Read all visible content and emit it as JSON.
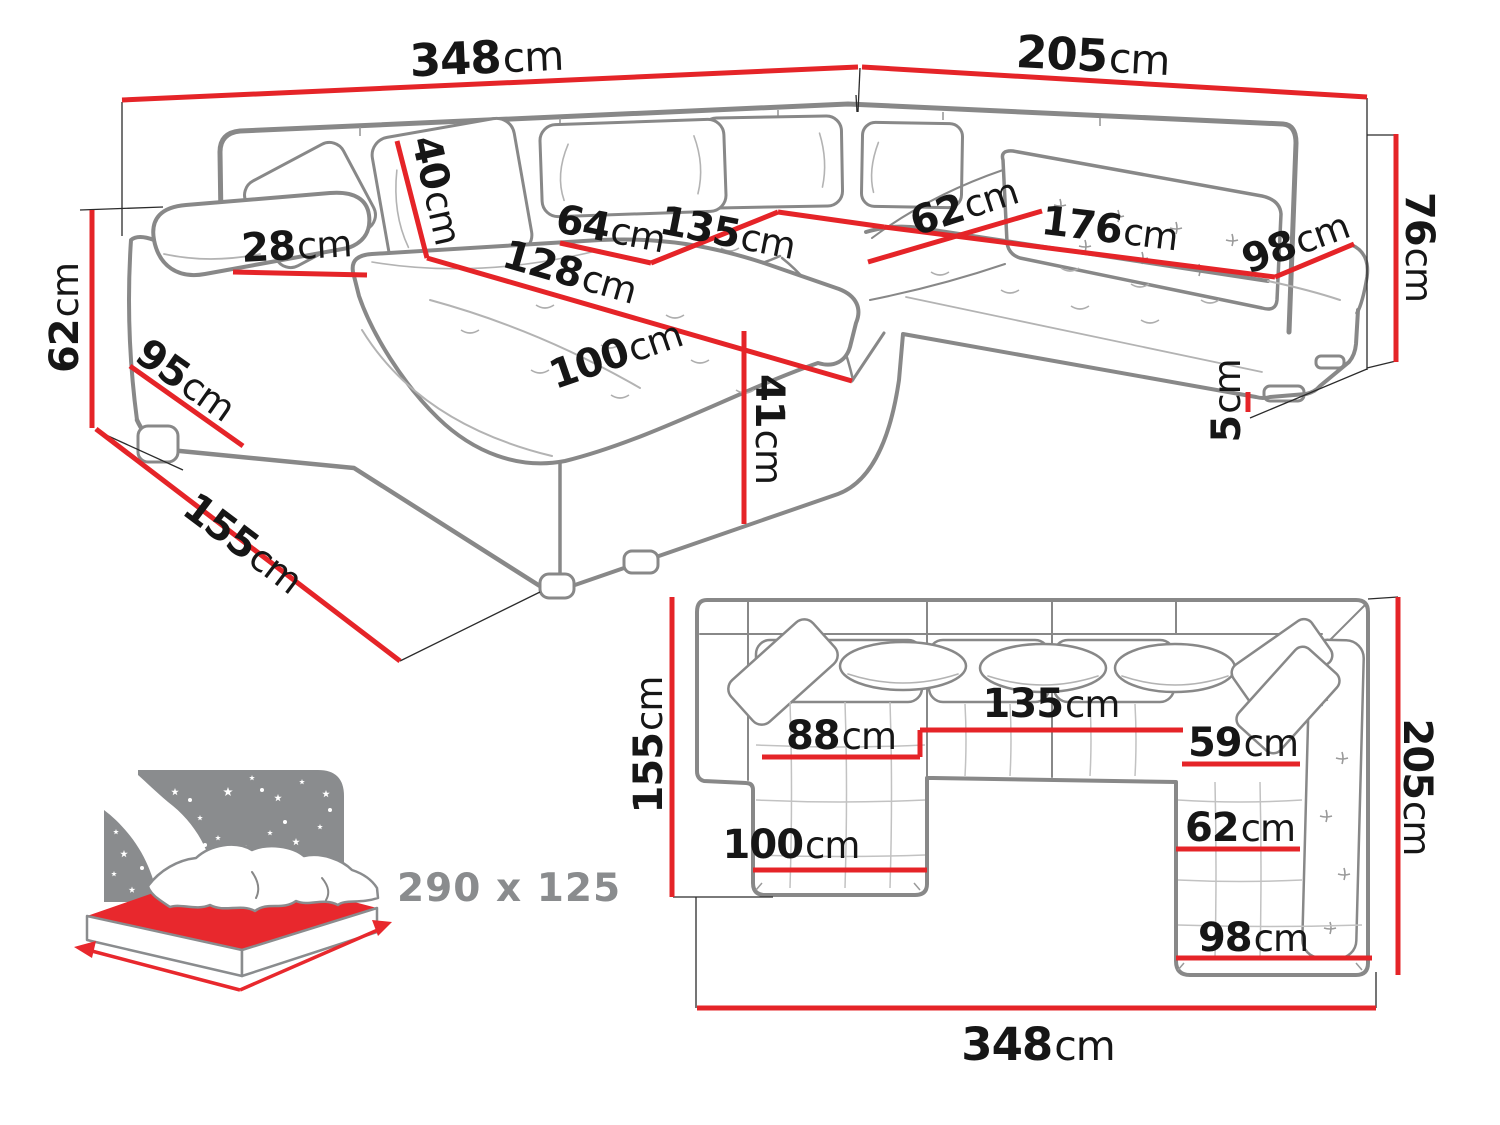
{
  "colors": {
    "dimension_red": "#e52428",
    "furniture_gray": "#888888",
    "bed_icon_gray": "#8a8c8e",
    "label_black": "#161616"
  },
  "perspective": {
    "dims": {
      "back_width_left": {
        "v": "348",
        "u": "cm"
      },
      "back_width_right": {
        "v": "205",
        "u": "cm"
      },
      "arm_height": {
        "v": "62",
        "u": "cm"
      },
      "arm_top_width": {
        "v": "28",
        "u": "cm"
      },
      "arm_depth": {
        "v": "95",
        "u": "cm"
      },
      "chaise_total_depth": {
        "v": "155",
        "u": "cm"
      },
      "back_cushion": {
        "v": "40",
        "u": "cm"
      },
      "seat_depth_left": {
        "v": "64",
        "u": "cm"
      },
      "seat_width_middle": {
        "v": "135",
        "u": "cm"
      },
      "chaise_length": {
        "v": "128",
        "u": "cm"
      },
      "chaise_width": {
        "v": "100",
        "u": "cm"
      },
      "seat_height": {
        "v": "41",
        "u": "cm"
      },
      "seat_depth_corner": {
        "v": "62",
        "u": "cm"
      },
      "seat_width_right": {
        "v": "176",
        "u": "cm"
      },
      "seat_depth_right": {
        "v": "98",
        "u": "cm"
      },
      "back_height": {
        "v": "76",
        "u": "cm"
      },
      "leg_height": {
        "v": "5",
        "u": "cm"
      }
    }
  },
  "plan": {
    "dims": {
      "chaise_depth": {
        "v": "155",
        "u": "cm"
      },
      "seat_left": {
        "v": "88",
        "u": "cm"
      },
      "seat_middle": {
        "v": "135",
        "u": "cm"
      },
      "seat_right": {
        "v": "59",
        "u": "cm"
      },
      "chaise_width": {
        "v": "100",
        "u": "cm"
      },
      "right_seat_width": {
        "v": "62",
        "u": "cm"
      },
      "right_depth": {
        "v": "98",
        "u": "cm"
      },
      "side_depth": {
        "v": "205",
        "u": "cm"
      },
      "total_width": {
        "v": "348",
        "u": "cm"
      }
    }
  },
  "sleeping": {
    "size": "290 x 125"
  }
}
